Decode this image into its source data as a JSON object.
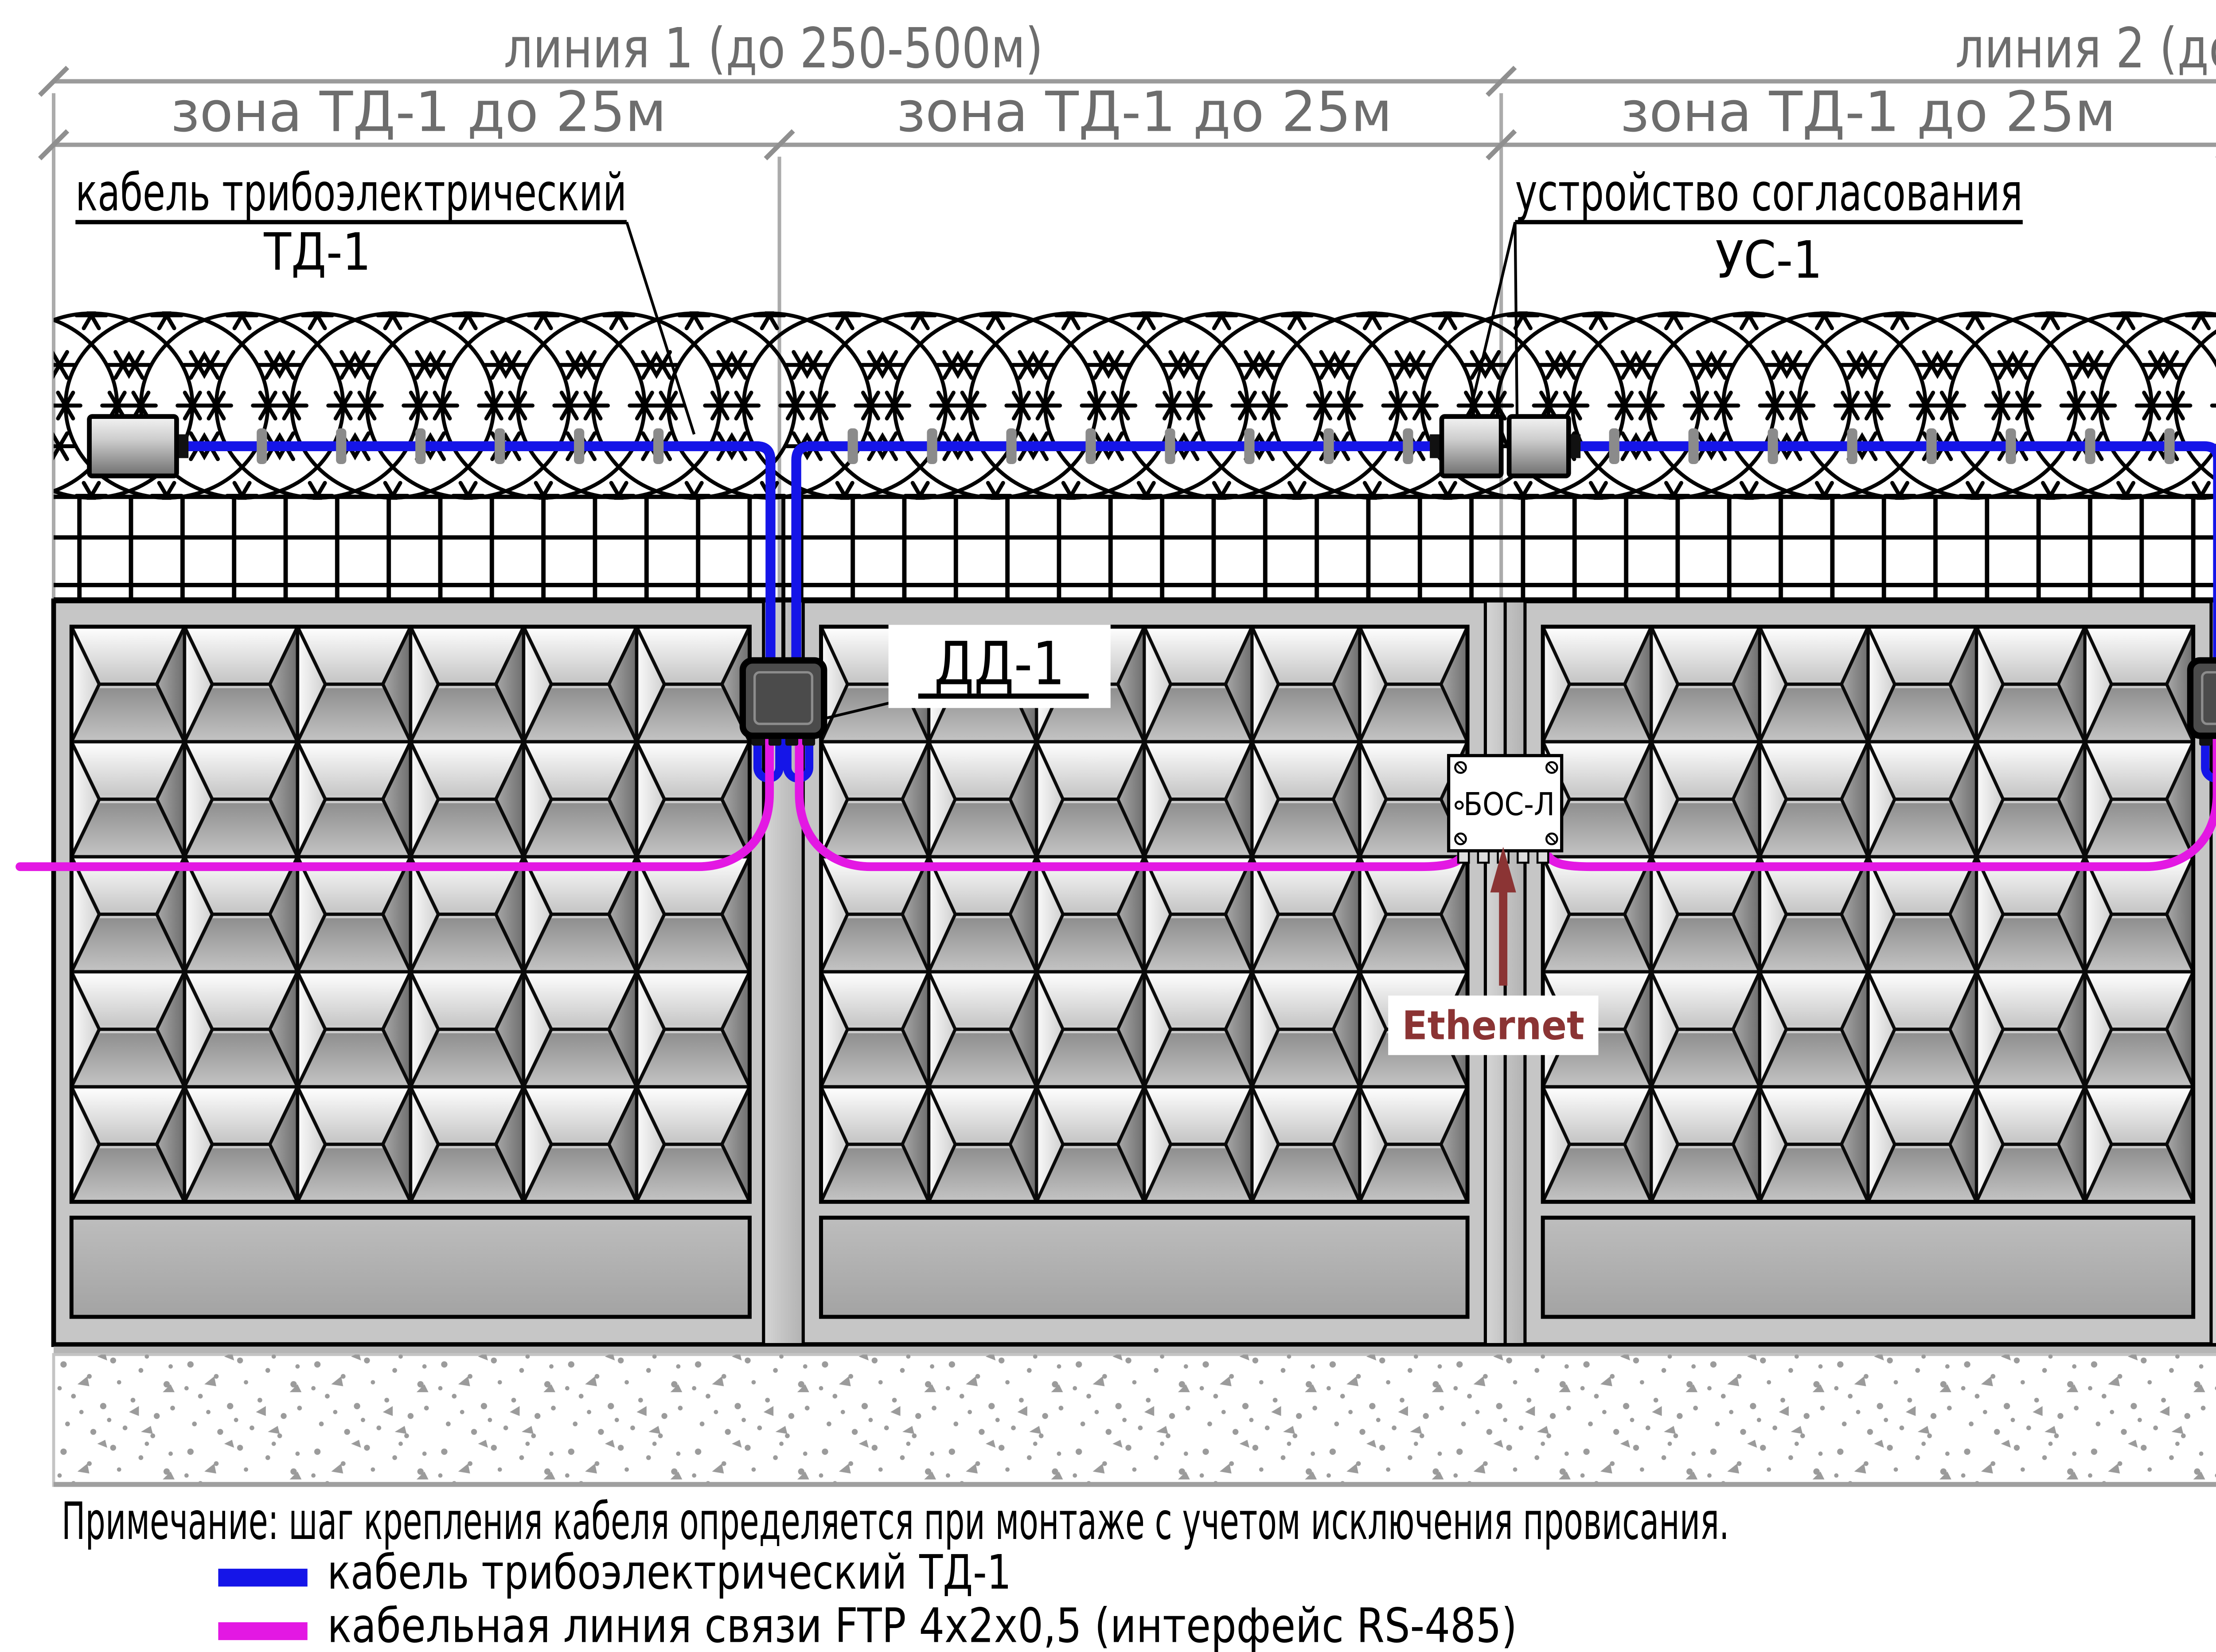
{
  "dimensions": {
    "line1": "линия 1  (до 250-500м)",
    "line2": "линия 2  (до 250-500м)",
    "zone": "зона ТД-1 до 25м"
  },
  "labels": {
    "cable_left_1": "кабель трибоэлектрический",
    "cable_left_2": "ТД-1",
    "matching_device_1": "устройство согласования",
    "matching_device_2": "УС-1",
    "clamps": "хомуты",
    "cable_right_1": "кабель трибоэлектрический",
    "cable_right_2": "ТД-1",
    "wire": "проволока"
  },
  "devices": {
    "dd1": "ДД-1",
    "bos": "БОС-Л",
    "ethernet": "Ethernet"
  },
  "note": "Примечание: шаг крепления кабеля определяется при монтаже с учетом исключения провисания.",
  "legend": [
    {
      "label": "кабель трибоэлектрический ТД-1",
      "color": "#1515e8"
    },
    {
      "label": "кабельная линия связи FTP 4x2x0,5 (интерфейс RS-485)",
      "color": "#e318e3"
    }
  ],
  "colors": {
    "sensor_cable": "#1515e8",
    "ftp_line": "#e318e3",
    "ethernet": "#8b3434",
    "dimension": "#9b9b9b"
  }
}
